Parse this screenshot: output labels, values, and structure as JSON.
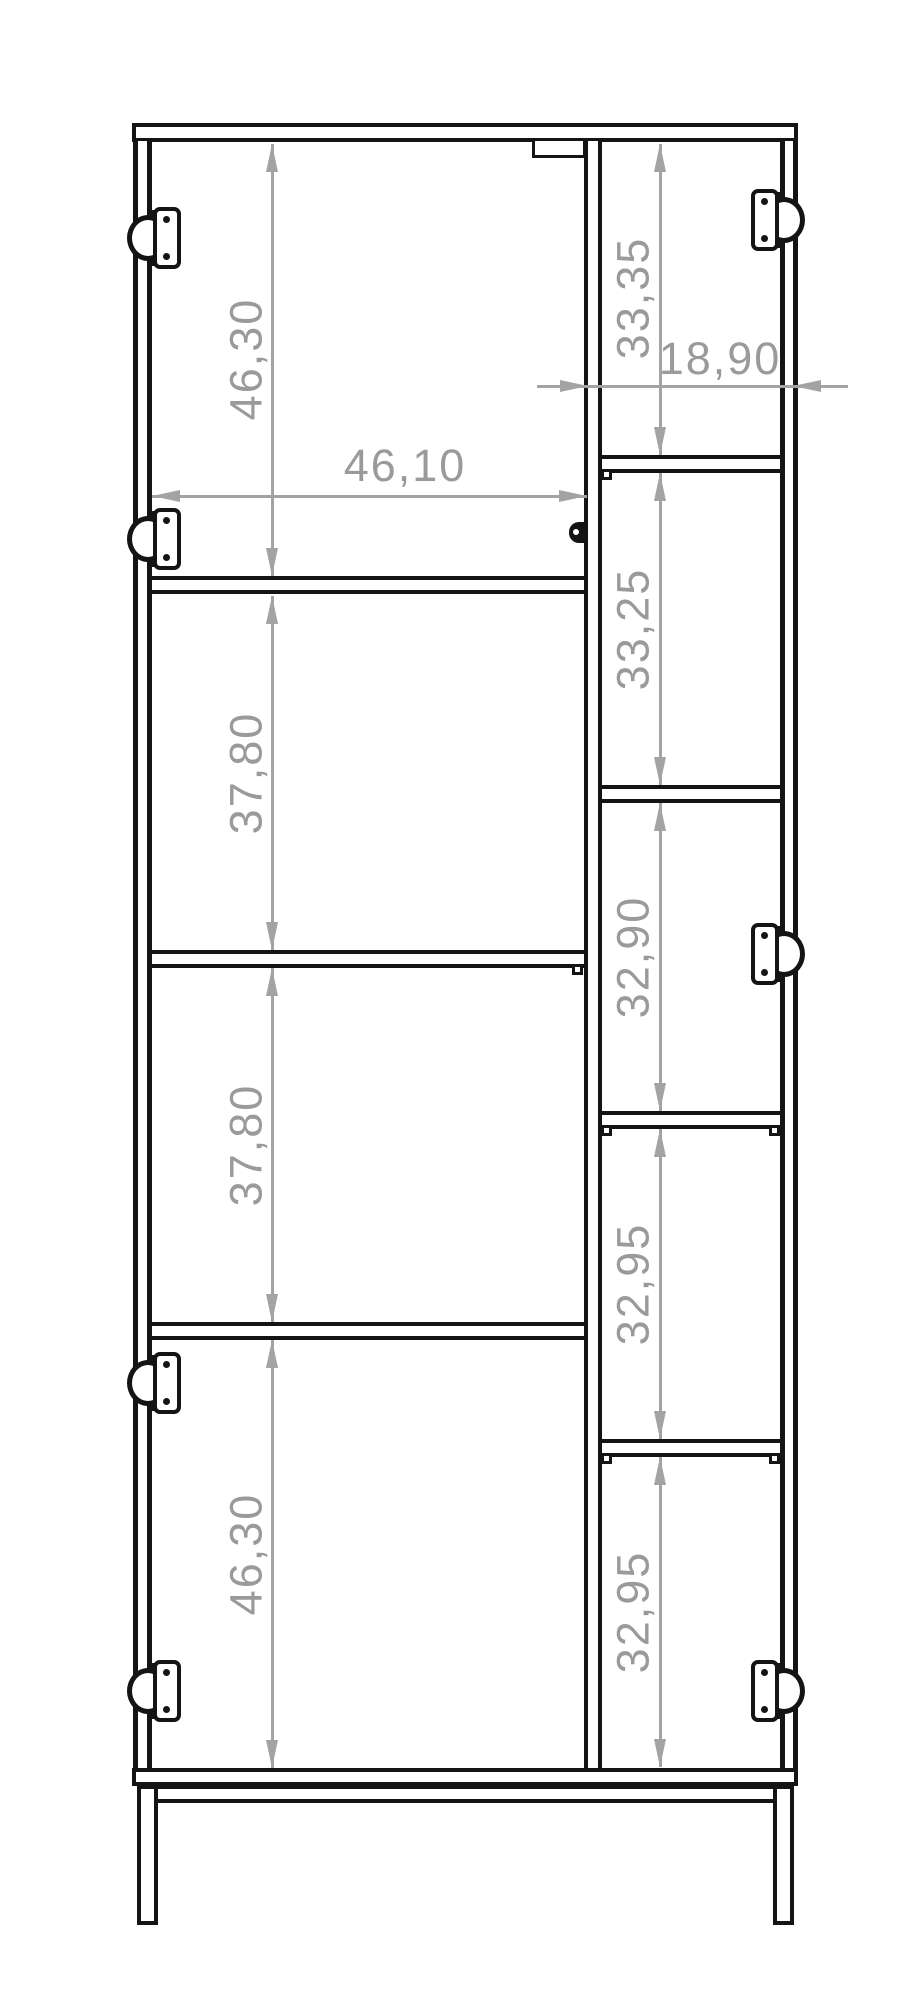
{
  "drawing": {
    "vertical_dims_left": [
      "46,30",
      "37,80",
      "37,80",
      "46,30"
    ],
    "vertical_dims_right": [
      "33,35",
      "33,25",
      "32,90",
      "32,95",
      "32,95"
    ],
    "horizontal_dims": {
      "left_compartment_width": "46,10",
      "right_compartment_width": "18,90"
    }
  },
  "icons": {
    "hinge": "concealed euro hinge",
    "catch": "door catch knob",
    "arrows": "dimension arrowheads"
  },
  "colors": {
    "structure_line": "#141414",
    "dimension_line": "#a3a3a3",
    "dimension_text": "#9a9a9a",
    "background": "#ffffff"
  }
}
